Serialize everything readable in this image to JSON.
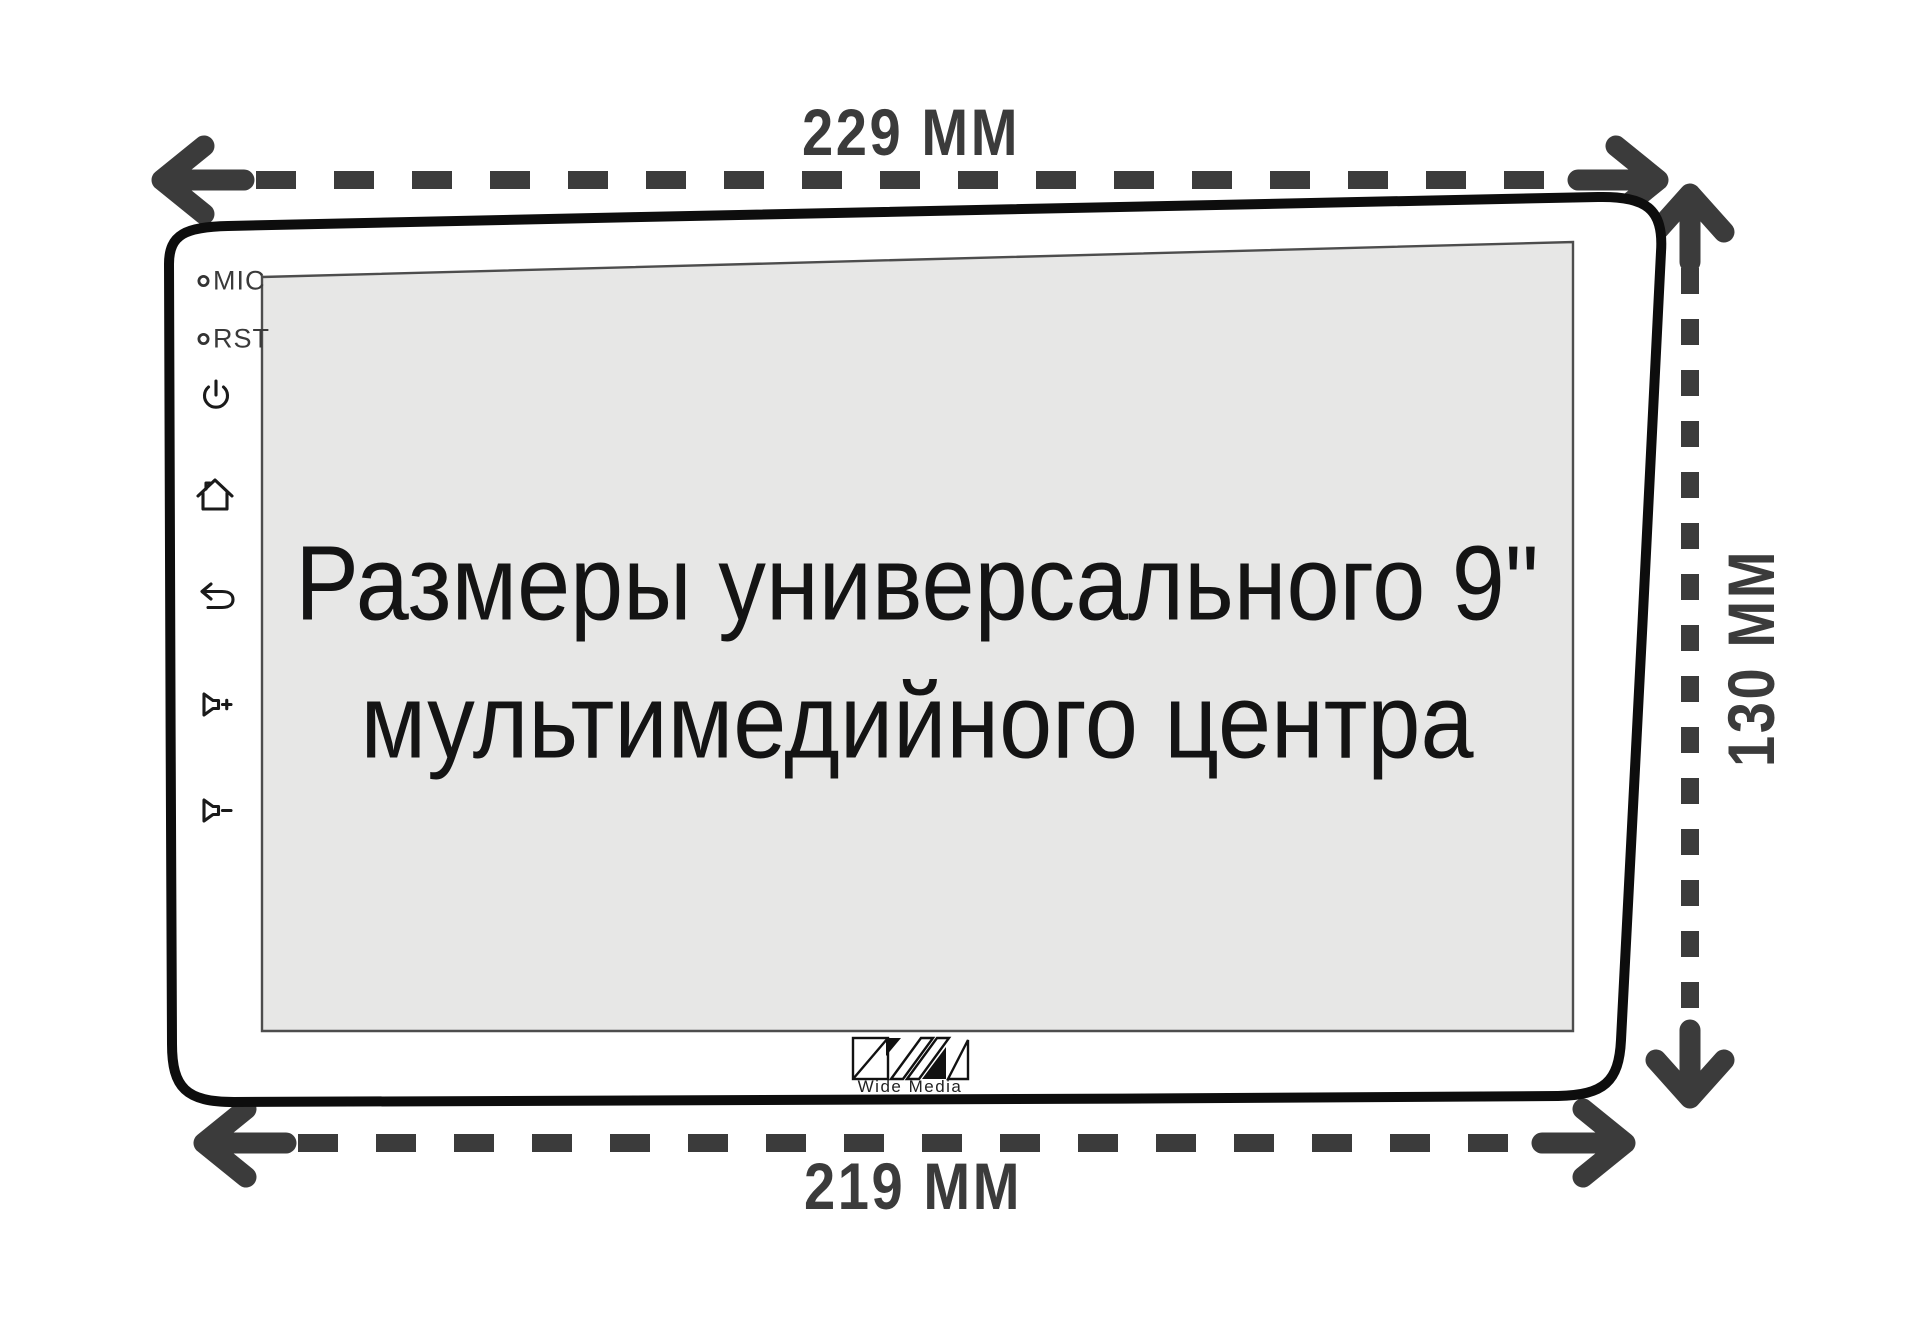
{
  "dimensions": {
    "top_width": "229 ММ",
    "bottom_width": "219 ММ",
    "side_height": "130 ММ"
  },
  "device": {
    "front_panel": {
      "ports": [
        {
          "icon": "mic-led",
          "label": "MIC"
        },
        {
          "icon": "rst-led",
          "label": "RST"
        }
      ],
      "buttons": [
        {
          "icon": "power-icon"
        },
        {
          "icon": "home-icon"
        },
        {
          "icon": "back-icon"
        },
        {
          "icon": "volume-up-icon"
        },
        {
          "icon": "volume-down-icon"
        }
      ]
    },
    "screen": {
      "caption_line1": "Размеры универсального 9\"",
      "caption_line2": "мультимедийного центра"
    },
    "brand": {
      "logo": "wide-media-logo",
      "label": "Wide Media"
    }
  },
  "colors": {
    "dimension_marks": "#3b3b3b",
    "device_outline": "#0d0d0d",
    "screen_fill": "#e7e7e6",
    "caption_text": "#141414",
    "background": "#ffffff"
  }
}
